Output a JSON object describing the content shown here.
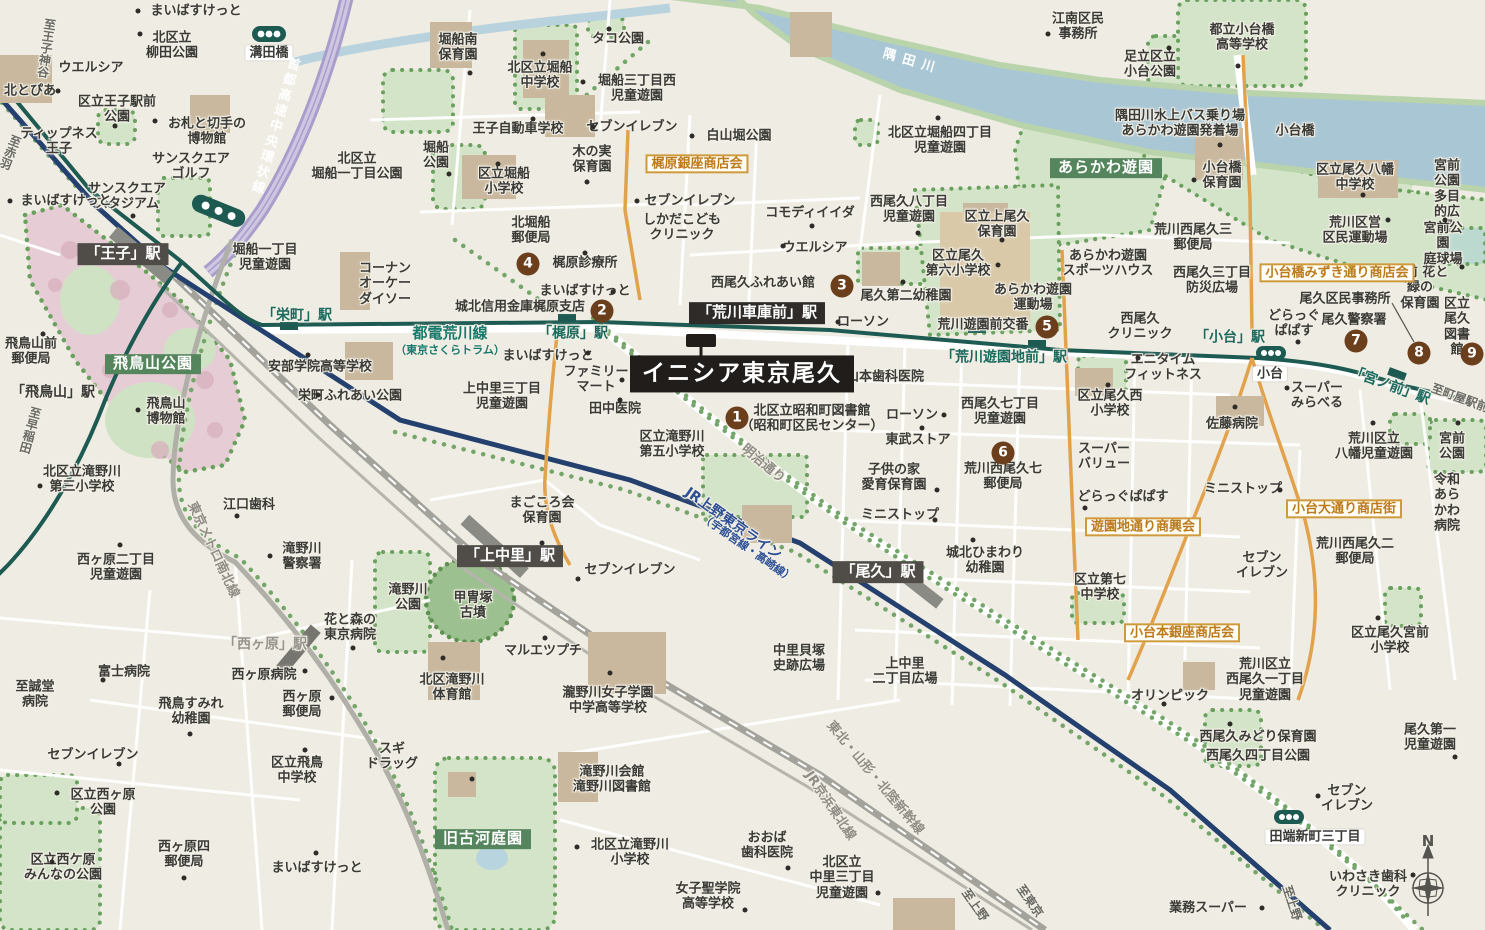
{
  "title": "イニシア東京尾久 周辺地図",
  "compass": {
    "n": "N"
  },
  "colors": {
    "tram_line": "#1d5a52",
    "jr_line": "#24406e",
    "expressway": "#a99dcb",
    "river": "#a9c6d4",
    "shopping_street": "#e2a24b",
    "park": "#d3e4c8",
    "marker_circle": "#6b3e1c",
    "property_box": "#211d1a"
  },
  "property": {
    "name": "イニシア東京尾久"
  },
  "numbered_markers": [
    {
      "no": "1",
      "x": 737,
      "y": 418
    },
    {
      "no": "2",
      "x": 602,
      "y": 311
    },
    {
      "no": "3",
      "x": 842,
      "y": 286
    },
    {
      "no": "4",
      "x": 528,
      "y": 264
    },
    {
      "no": "5",
      "x": 1047,
      "y": 327
    },
    {
      "no": "6",
      "x": 1003,
      "y": 453
    },
    {
      "no": "7",
      "x": 1356,
      "y": 341
    },
    {
      "no": "8",
      "x": 1419,
      "y": 353
    },
    {
      "no": "9",
      "x": 1472,
      "y": 354
    }
  ],
  "labels": [
    {
      "t": "まいばすけっと",
      "x": 196,
      "y": 11
    },
    {
      "t": "北区立\n柳田公園",
      "x": 172,
      "y": 46
    },
    {
      "t": "溝田橋",
      "x": 269,
      "y": 53,
      "k": "pw"
    },
    {
      "t": "ウエルシア",
      "x": 91,
      "y": 68
    },
    {
      "t": "北とぴあ",
      "x": 30,
      "y": 91
    },
    {
      "t": "区立王子駅前\n公園",
      "x": 117,
      "y": 110
    },
    {
      "t": "お札と切手の\n博物館",
      "x": 207,
      "y": 132
    },
    {
      "t": "ティップネス\n王子",
      "x": 59,
      "y": 142
    },
    {
      "t": "至王子神谷",
      "x": 46,
      "y": 48,
      "k": "dir",
      "v": 1,
      "r": 8
    },
    {
      "t": "至赤羽",
      "x": 10,
      "y": 152,
      "k": "dir",
      "v": 1,
      "r": 22
    },
    {
      "t": "サンスクエア\nゴルフ",
      "x": 191,
      "y": 167
    },
    {
      "t": "サンスクエア\nスタジアム",
      "x": 127,
      "y": 197
    },
    {
      "t": "まいばすけっと",
      "x": 66,
      "y": 201
    },
    {
      "t": "首都高速中央環状線",
      "x": 274,
      "y": 126,
      "k": "lw",
      "v": 1,
      "r": 16,
      "ls": 3
    },
    {
      "t": "北区立\n堀船一丁目公園",
      "x": 357,
      "y": 167
    },
    {
      "t": "堀船一丁目\n児童遊園",
      "x": 265,
      "y": 258
    },
    {
      "t": "「王子」駅",
      "x": 123,
      "y": 254,
      "k": "stj",
      "n": "oji-station-label"
    },
    {
      "t": "堀船南\n保育園",
      "x": 458,
      "y": 48
    },
    {
      "t": "北区立堀船\n中学校",
      "x": 540,
      "y": 76
    },
    {
      "t": "タコ公園",
      "x": 618,
      "y": 39
    },
    {
      "t": "堀船三丁目西\n児童遊園",
      "x": 637,
      "y": 89
    },
    {
      "t": "セブンイレブン",
      "x": 632,
      "y": 127
    },
    {
      "t": "白山堀公園",
      "x": 739,
      "y": 136
    },
    {
      "t": "王子自動車学校",
      "x": 518,
      "y": 129
    },
    {
      "t": "堀船\n公園",
      "x": 436,
      "y": 156
    },
    {
      "t": "区立堀船\n小学校",
      "x": 504,
      "y": 182
    },
    {
      "t": "木の実\n保育園",
      "x": 592,
      "y": 160
    },
    {
      "t": "梶原銀座商店会",
      "x": 697,
      "y": 164,
      "k": "shop"
    },
    {
      "t": "セブンイレブン",
      "x": 690,
      "y": 201
    },
    {
      "t": "しかだこども\nクリニック",
      "x": 682,
      "y": 228
    },
    {
      "t": "北堀船\n郵便局",
      "x": 531,
      "y": 231
    },
    {
      "t": "コモディイイダ",
      "x": 810,
      "y": 213
    },
    {
      "t": "江南区民\n事務所",
      "x": 1078,
      "y": 27
    },
    {
      "t": "足立区立\n小台公園",
      "x": 1150,
      "y": 65
    },
    {
      "t": "都立小台橋\n高等学校",
      "x": 1242,
      "y": 38
    },
    {
      "t": "隅田川",
      "x": 912,
      "y": 62,
      "k": "lw",
      "r": 16,
      "ls": 7
    },
    {
      "t": "隅田川水上バス乗り場\nあらかわ遊園発着場",
      "x": 1180,
      "y": 124
    },
    {
      "t": "小台橋",
      "x": 1295,
      "y": 131
    },
    {
      "t": "北区立堀船四丁目\n児童遊園",
      "x": 940,
      "y": 141
    },
    {
      "t": "あらかわ遊園",
      "x": 1106,
      "y": 168,
      "k": "area"
    },
    {
      "t": "西尾久八丁目\n児童遊園",
      "x": 909,
      "y": 210
    },
    {
      "t": "区立上尾久\n保育園",
      "x": 997,
      "y": 225
    },
    {
      "t": "あらかわ遊園\nスポーツハウス",
      "x": 1108,
      "y": 264
    },
    {
      "t": "西尾久三丁目\n防災広場",
      "x": 1212,
      "y": 281
    },
    {
      "t": "荒川西尾久三\n郵便局",
      "x": 1193,
      "y": 238
    },
    {
      "t": "尾久区民事務所",
      "x": 1345,
      "y": 299
    },
    {
      "t": "宮前 花と緑の\n保育園",
      "x": 1420,
      "y": 288
    },
    {
      "t": "宮前公園\n多目的広場",
      "x": 1447,
      "y": 197
    },
    {
      "t": "宮前公園\n庭球場",
      "x": 1443,
      "y": 244
    },
    {
      "t": "荒川区営\n区民運動場",
      "x": 1355,
      "y": 231
    },
    {
      "t": "区立尾久八幡\n中学校",
      "x": 1355,
      "y": 178
    },
    {
      "t": "区立尾久\n図書館",
      "x": 1457,
      "y": 327
    },
    {
      "t": "尾久警察署",
      "x": 1354,
      "y": 320
    },
    {
      "t": "どらっぐ\nぱぱす",
      "x": 1294,
      "y": 324
    },
    {
      "t": "小台橋みずき通り商店会",
      "x": 1337,
      "y": 273,
      "k": "shop"
    },
    {
      "t": "小台橋\n保育園",
      "x": 1222,
      "y": 176
    },
    {
      "t": "コーナン\nオーケー\nダイソー",
      "x": 385,
      "y": 284
    },
    {
      "t": "「栄町」駅",
      "x": 297,
      "y": 316,
      "k": "stt"
    },
    {
      "t": "飛鳥山前\n郵便局",
      "x": 31,
      "y": 352
    },
    {
      "t": "飛鳥山公園",
      "x": 153,
      "y": 364,
      "k": "area"
    },
    {
      "t": "安部学院高等学校",
      "x": 320,
      "y": 367
    },
    {
      "t": "栄町ふれあい公園",
      "x": 350,
      "y": 396
    },
    {
      "t": "「飛鳥山」駅",
      "x": 53,
      "y": 393,
      "k": "stb"
    },
    {
      "t": "飛鳥山\n博物館",
      "x": 166,
      "y": 412
    },
    {
      "t": "至早稲田",
      "x": 30,
      "y": 430,
      "k": "dir",
      "v": 1,
      "r": 15
    },
    {
      "t": "北区立滝野川\n第三小学校",
      "x": 82,
      "y": 480
    },
    {
      "t": "都電荒川線",
      "x": 450,
      "y": 334,
      "k": "ltl",
      "s": 15
    },
    {
      "t": "（東京さくらトラム）",
      "x": 450,
      "y": 351,
      "k": "ltl",
      "s": 11
    },
    {
      "t": "城北信用金庫梶原支店",
      "x": 520,
      "y": 307
    },
    {
      "t": "梶原診療所",
      "x": 585,
      "y": 263
    },
    {
      "t": "まいばすけっと",
      "x": 585,
      "y": 291
    },
    {
      "t": "「梶原」駅",
      "x": 573,
      "y": 334,
      "k": "stt"
    },
    {
      "t": "まいばすけっと",
      "x": 548,
      "y": 356
    },
    {
      "t": "ファミリー\nマート",
      "x": 596,
      "y": 380
    },
    {
      "t": "田中医院",
      "x": 615,
      "y": 409
    },
    {
      "t": "上中里三丁目\n児童遊園",
      "x": 502,
      "y": 397
    },
    {
      "t": "「荒川車庫前」駅",
      "x": 757,
      "y": 313,
      "k": "stjd",
      "n": "arakawa-shako-mae-station-label"
    },
    {
      "t": "西尾久ふれあい館",
      "x": 763,
      "y": 283
    },
    {
      "t": "ウエルシア",
      "x": 815,
      "y": 248
    },
    {
      "t": "尾久第二幼稚園",
      "x": 906,
      "y": 296
    },
    {
      "t": "区立尾久\n第六小学校",
      "x": 958,
      "y": 264
    },
    {
      "t": "あらかわ遊園\n運動場",
      "x": 1033,
      "y": 298
    },
    {
      "t": "ローソン",
      "x": 863,
      "y": 322
    },
    {
      "t": "荒川遊園前交番",
      "x": 983,
      "y": 325
    },
    {
      "t": "西尾久\nクリニック",
      "x": 1140,
      "y": 327
    },
    {
      "t": "「荒川遊園地前」駅",
      "x": 1004,
      "y": 358,
      "k": "stt"
    },
    {
      "t": "山本歯科医院",
      "x": 885,
      "y": 377
    },
    {
      "t": "エニタイム\nフィットネス",
      "x": 1163,
      "y": 368
    },
    {
      "t": "区立尾久西\n小学校",
      "x": 1110,
      "y": 404
    },
    {
      "t": "北区立昭和町図書館\n（昭和町区民センター）",
      "x": 812,
      "y": 419
    },
    {
      "t": "ローソン",
      "x": 912,
      "y": 415
    },
    {
      "t": "東武ストア",
      "x": 918,
      "y": 440
    },
    {
      "t": "西尾久七丁目\n児童遊園",
      "x": 1000,
      "y": 412
    },
    {
      "t": "区立滝野川\n第五小学校",
      "x": 672,
      "y": 445
    },
    {
      "t": "明治通り",
      "x": 763,
      "y": 464,
      "k": "lg",
      "r": 40
    },
    {
      "t": "スーパー\nバリュー",
      "x": 1104,
      "y": 457
    },
    {
      "t": "どらっぐぱぱす",
      "x": 1123,
      "y": 497
    },
    {
      "t": "子供の家\n愛育保育園",
      "x": 894,
      "y": 478
    },
    {
      "t": "荒川西尾久七\n郵便局",
      "x": 1003,
      "y": 477
    },
    {
      "t": "ミニストップ",
      "x": 900,
      "y": 515
    },
    {
      "t": "ミニストップ",
      "x": 1243,
      "y": 489
    },
    {
      "t": "遊園地通り商興会",
      "x": 1143,
      "y": 527,
      "k": "shop"
    },
    {
      "t": "城北ひまわり\n幼稚園",
      "x": 985,
      "y": 561
    },
    {
      "t": "区立第七\n中学校",
      "x": 1100,
      "y": 588
    },
    {
      "t": "「尾久」駅",
      "x": 878,
      "y": 572,
      "k": "stj",
      "n": "oku-station-label"
    },
    {
      "t": "小台本銀座商店会",
      "x": 1182,
      "y": 633,
      "k": "shop"
    },
    {
      "t": "上中里\n二丁目広場",
      "x": 905,
      "y": 672
    },
    {
      "t": "中里貝塚\n史跡広場",
      "x": 799,
      "y": 659
    },
    {
      "t": "甲冑塚\n古墳",
      "x": 473,
      "y": 606
    },
    {
      "t": "滝野川\n公園",
      "x": 408,
      "y": 598
    },
    {
      "t": "「上中里」駅",
      "x": 510,
      "y": 556,
      "k": "stj",
      "n": "kami-nakazato-station-label"
    },
    {
      "t": "まごころ会\n保育園",
      "x": 542,
      "y": 511
    },
    {
      "t": "セブンイレブン",
      "x": 630,
      "y": 570
    },
    {
      "t": "JR上野東京ライン",
      "x": 733,
      "y": 524,
      "k": "lb2",
      "r": 35,
      "s": 14
    },
    {
      "t": "（宇都宮線・高崎線）",
      "x": 747,
      "y": 549,
      "k": "lb2",
      "r": 35,
      "s": 11
    },
    {
      "t": "マルエツプチ",
      "x": 543,
      "y": 651
    },
    {
      "t": "北区滝野川\n体育館",
      "x": 452,
      "y": 688
    },
    {
      "t": "瀧野川女子学園\n中学高等学校",
      "x": 608,
      "y": 701
    },
    {
      "t": "東京メトロ南北線",
      "x": 213,
      "y": 550,
      "k": "lg",
      "r": 65
    },
    {
      "t": "江口歯科",
      "x": 249,
      "y": 505
    },
    {
      "t": "滝野川\n警察署",
      "x": 302,
      "y": 557
    },
    {
      "t": "西ヶ原二丁目\n児童遊園",
      "x": 116,
      "y": 568
    },
    {
      "t": "花と森の\n東京病院",
      "x": 350,
      "y": 628
    },
    {
      "t": "「西ヶ原」駅",
      "x": 265,
      "y": 645,
      "k": "stg"
    },
    {
      "t": "西ヶ原病院",
      "x": 264,
      "y": 675
    },
    {
      "t": "富士病院",
      "x": 124,
      "y": 672
    },
    {
      "t": "至誠堂\n病院",
      "x": 35,
      "y": 695
    },
    {
      "t": "飛鳥すみれ\n幼稚園",
      "x": 191,
      "y": 712
    },
    {
      "t": "西ヶ原\n郵便局",
      "x": 302,
      "y": 705
    },
    {
      "t": "区立飛鳥\n中学校",
      "x": 297,
      "y": 771
    },
    {
      "t": "スギ\nドラッグ",
      "x": 392,
      "y": 757
    },
    {
      "t": "セブンイレブン",
      "x": 93,
      "y": 755
    },
    {
      "t": "区立西ヶ原\n公園",
      "x": 103,
      "y": 803
    },
    {
      "t": "区立西ケ原\nみんなの公園",
      "x": 63,
      "y": 868
    },
    {
      "t": "西ヶ原四\n郵便局",
      "x": 184,
      "y": 855
    },
    {
      "t": "まいばすけっと",
      "x": 317,
      "y": 868
    },
    {
      "t": "旧古河庭園",
      "x": 483,
      "y": 839,
      "k": "area"
    },
    {
      "t": "滝野川会館\n滝野川図書館",
      "x": 612,
      "y": 780
    },
    {
      "t": "北区立滝野川\n小学校",
      "x": 630,
      "y": 853
    },
    {
      "t": "おおば\n歯科医院",
      "x": 767,
      "y": 846
    },
    {
      "t": "女子聖学院\n高等学校",
      "x": 708,
      "y": 897
    },
    {
      "t": "東北・山形・北陸新幹線",
      "x": 875,
      "y": 778,
      "k": "lg",
      "r": 50
    },
    {
      "t": "JR京浜東北線",
      "x": 830,
      "y": 806,
      "k": "lg",
      "r": 56
    },
    {
      "t": "北区立\n中里三丁目\n児童遊園",
      "x": 842,
      "y": 878
    },
    {
      "t": "至上野",
      "x": 975,
      "y": 905,
      "k": "dir",
      "r": 55
    },
    {
      "t": "至東京",
      "x": 1030,
      "y": 901,
      "k": "dir",
      "r": 55
    },
    {
      "t": "至上野",
      "x": 1292,
      "y": 903,
      "k": "dir",
      "r": 72
    },
    {
      "t": "業務スーパー",
      "x": 1208,
      "y": 908
    },
    {
      "t": "いわさき歯科\nクリニック",
      "x": 1368,
      "y": 885
    },
    {
      "t": "田端新町三丁目",
      "x": 1315,
      "y": 837,
      "k": "pw"
    },
    {
      "t": "尾久第一\n児童遊園",
      "x": 1430,
      "y": 738
    },
    {
      "t": "セブン\nイレブン",
      "x": 1347,
      "y": 799
    },
    {
      "t": "セブン\nイレブン",
      "x": 1262,
      "y": 566
    },
    {
      "t": "荒川西尾久二\n郵便局",
      "x": 1355,
      "y": 552
    },
    {
      "t": "小台大通り商店街",
      "x": 1344,
      "y": 509,
      "k": "shop"
    },
    {
      "t": "令和\nあらかわ\n病院",
      "x": 1447,
      "y": 503
    },
    {
      "t": "荒川区立\n八幡児童遊園",
      "x": 1374,
      "y": 447
    },
    {
      "t": "宮前\n公園",
      "x": 1452,
      "y": 447
    },
    {
      "t": "佐藤病院",
      "x": 1232,
      "y": 424
    },
    {
      "t": "スーパー\nみらべる",
      "x": 1317,
      "y": 396
    },
    {
      "t": "荒川区立\n西尾久一丁目\n児童遊園",
      "x": 1265,
      "y": 680
    },
    {
      "t": "西尾久みどり保育園",
      "x": 1258,
      "y": 737
    },
    {
      "t": "西尾久四丁目公園",
      "x": 1258,
      "y": 756
    },
    {
      "t": "オリンピック",
      "x": 1170,
      "y": 696
    },
    {
      "t": "区立尾久宮前\n小学校",
      "x": 1390,
      "y": 641
    },
    {
      "t": "「小台」駅",
      "x": 1230,
      "y": 338,
      "k": "stt"
    },
    {
      "t": "小台",
      "x": 1270,
      "y": 374,
      "k": "pw"
    },
    {
      "t": "「宮ノ前」駅",
      "x": 1390,
      "y": 386,
      "k": "stt",
      "r": 20
    },
    {
      "t": "至町屋駅前",
      "x": 1460,
      "y": 398,
      "k": "dir",
      "r": 20
    },
    {
      "t": "イニシア東京尾久",
      "x": 742,
      "y": 374,
      "k": "prop",
      "n": "property-name-label"
    }
  ],
  "dots": [
    [
      138,
      11
    ],
    [
      140,
      34
    ],
    [
      58,
      91
    ],
    [
      155,
      121
    ],
    [
      115,
      126
    ],
    [
      133,
      216
    ],
    [
      10,
      201
    ],
    [
      470,
      73
    ],
    [
      543,
      54
    ],
    [
      609,
      29
    ],
    [
      583,
      82
    ],
    [
      593,
      127
    ],
    [
      692,
      136
    ],
    [
      533,
      119
    ],
    [
      449,
      174
    ],
    [
      498,
      164
    ],
    [
      587,
      182
    ],
    [
      637,
      201
    ],
    [
      812,
      226
    ],
    [
      783,
      246
    ],
    [
      903,
      282
    ],
    [
      998,
      265
    ],
    [
      838,
      322
    ],
    [
      1048,
      34
    ],
    [
      1169,
      48
    ],
    [
      1238,
      66
    ],
    [
      1220,
      145
    ],
    [
      938,
      118
    ],
    [
      1002,
      240
    ],
    [
      918,
      233
    ],
    [
      1194,
      180
    ],
    [
      1363,
      195
    ],
    [
      1445,
      220
    ],
    [
      1388,
      220
    ],
    [
      1462,
      267
    ],
    [
      1298,
      342
    ],
    [
      585,
      253
    ],
    [
      613,
      292
    ],
    [
      588,
      353
    ],
    [
      622,
      380
    ],
    [
      620,
      400
    ],
    [
      308,
      355
    ],
    [
      318,
      395
    ],
    [
      138,
      410
    ],
    [
      43,
      334
    ],
    [
      40,
      486
    ],
    [
      828,
      362
    ],
    [
      944,
      415
    ],
    [
      922,
      428
    ],
    [
      937,
      490
    ],
    [
      935,
      520
    ],
    [
      1280,
      490
    ],
    [
      973,
      540
    ],
    [
      1108,
      385
    ],
    [
      1138,
      358
    ],
    [
      1287,
      388
    ],
    [
      1235,
      407
    ],
    [
      1373,
      423
    ],
    [
      1458,
      423
    ],
    [
      1164,
      704
    ],
    [
      1230,
      724
    ],
    [
      1455,
      757
    ],
    [
      1318,
      796
    ],
    [
      1413,
      875
    ],
    [
      1262,
      908
    ],
    [
      542,
      543
    ],
    [
      578,
      579
    ],
    [
      545,
      638
    ],
    [
      443,
      658
    ],
    [
      610,
      673
    ],
    [
      1085,
      508
    ],
    [
      237,
      516
    ],
    [
      270,
      556
    ],
    [
      120,
      545
    ],
    [
      353,
      648
    ],
    [
      305,
      671
    ],
    [
      103,
      680
    ],
    [
      190,
      734
    ],
    [
      332,
      698
    ],
    [
      305,
      750
    ],
    [
      119,
      764
    ],
    [
      57,
      793
    ],
    [
      52,
      862
    ],
    [
      184,
      878
    ],
    [
      316,
      853
    ],
    [
      472,
      779
    ],
    [
      577,
      847
    ],
    [
      788,
      868
    ],
    [
      745,
      910
    ],
    [
      878,
      893
    ],
    [
      1378,
      618
    ]
  ]
}
